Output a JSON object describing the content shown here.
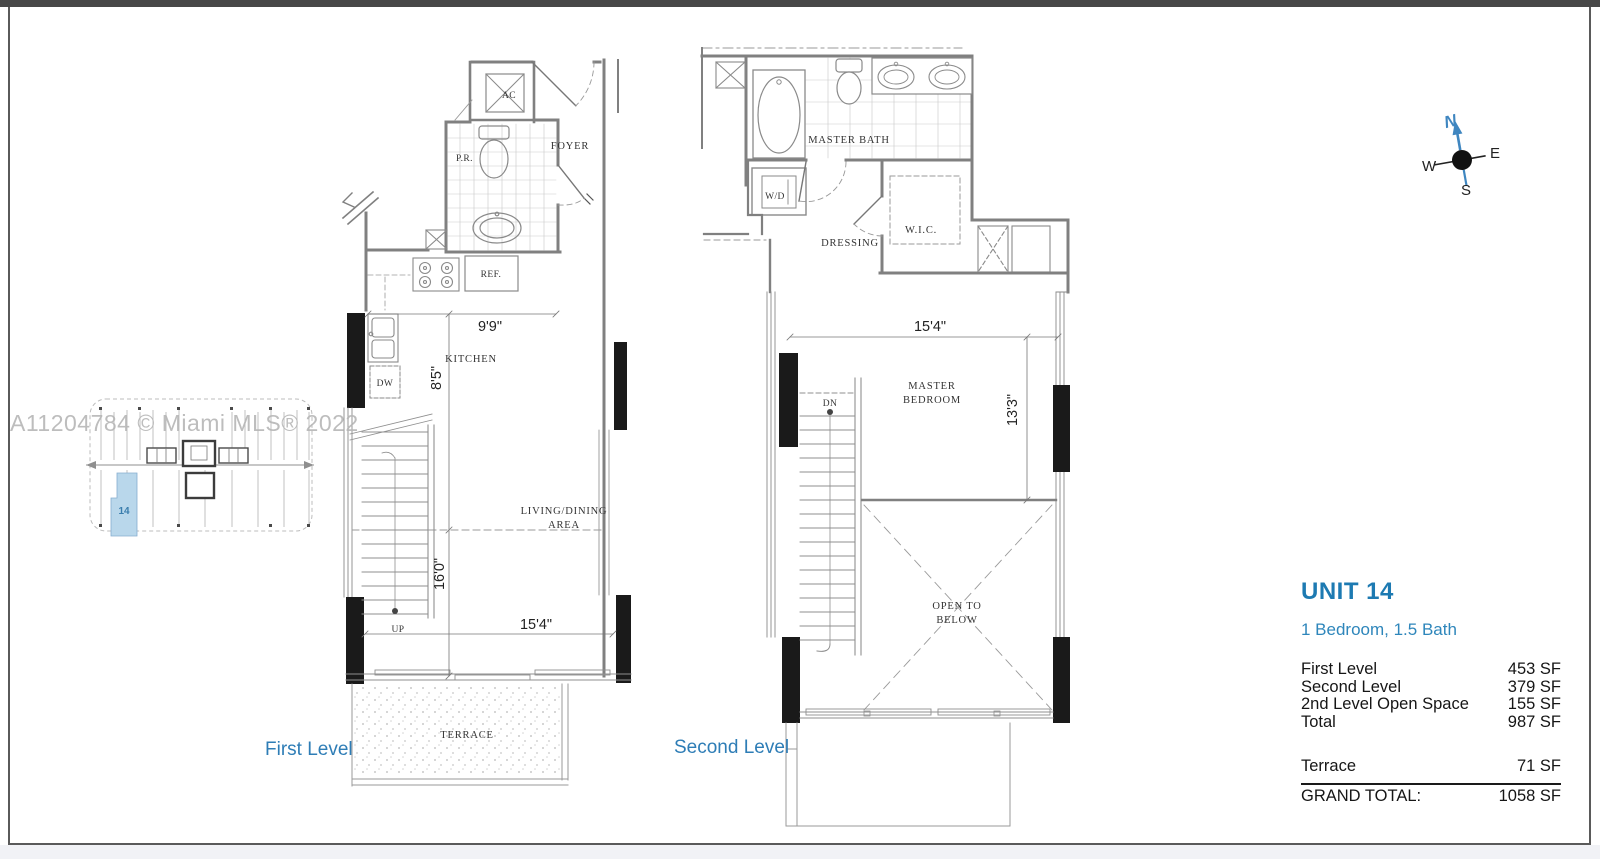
{
  "watermark": "A11204784 © Miami MLS® 2022",
  "colors": {
    "accent_blue": "#2e7db6",
    "unit_highlight": "#b9d7eb",
    "wall_gray": "#808080",
    "poche_black": "#1a1a1a",
    "watermark_gray": "#b6b6b6"
  },
  "key_plan": {
    "unit_label": "14"
  },
  "first_level": {
    "title": "First Level",
    "rooms": {
      "ac": "AC",
      "pr": "P.R.",
      "foyer": "FOYER",
      "ref": "REF.",
      "dw": "DW",
      "kitchen": "KITCHEN",
      "living1": "LIVING/DINING",
      "living2": "AREA",
      "up": "UP",
      "terrace": "TERRACE"
    },
    "dims": {
      "kitchen_width": "9'9\"",
      "kitchen_depth": "8'5\"",
      "living_depth": "16'0\"",
      "living_width": "15'4\""
    }
  },
  "second_level": {
    "title": "Second Level",
    "rooms": {
      "master_bath": "MASTER BATH",
      "wd": "W/D",
      "dressing": "DRESSING",
      "wic": "W.I.C.",
      "dn": "DN",
      "bedroom1": "MASTER",
      "bedroom2": "BEDROOM",
      "open1": "OPEN TO",
      "open2": "BELOW"
    },
    "dims": {
      "bedroom_width": "15'4\"",
      "bedroom_depth": "13'3\""
    }
  },
  "compass": {
    "n": "N",
    "e": "E",
    "s": "S",
    "w": "W"
  },
  "info_panel": {
    "unit_title": "UNIT 14",
    "subtitle": "1 Bedroom, 1.5 Bath",
    "rows": [
      {
        "label": "First Level",
        "value": "453 SF"
      },
      {
        "label": "Second Level",
        "value": "379 SF"
      },
      {
        "label": "2nd Level Open Space",
        "value": "155 SF"
      },
      {
        "label": "Total",
        "value": "987 SF"
      }
    ],
    "terrace_row": {
      "label": "Terrace",
      "value": "71 SF"
    },
    "grand_total_row": {
      "label": "GRAND TOTAL:",
      "value": "1058 SF"
    }
  }
}
